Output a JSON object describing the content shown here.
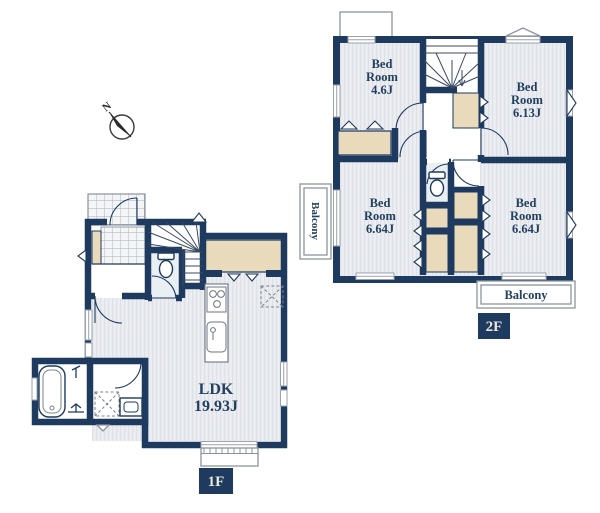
{
  "compass": {
    "north": "N"
  },
  "floor2": {
    "badge": "2F",
    "rooms": {
      "bedroom_46": {
        "line1": "Bed",
        "line2": "Room",
        "line3": "4.6J"
      },
      "bedroom_613": {
        "line1": "Bed",
        "line2": "Room",
        "line3": "6.13J"
      },
      "bedroom_664_left": {
        "line1": "Bed",
        "line2": "Room",
        "line3": "6.64J"
      },
      "bedroom_664_right": {
        "line1": "Bed",
        "line2": "Room",
        "line3": "6.64J"
      }
    },
    "balcony_left": "Balcony",
    "balcony_bottom": "Balcony"
  },
  "floor1": {
    "badge": "1F",
    "ldk": {
      "line1": "LDK",
      "line2": "19.93J"
    }
  },
  "colors": {
    "wall": "#1e3a5e",
    "closet": "#e8dabb",
    "floor_stripe": "#ebedf1",
    "label_text": "#24405f",
    "badge_bg": "#1e3a5e",
    "badge_text": "#e9e6da"
  }
}
